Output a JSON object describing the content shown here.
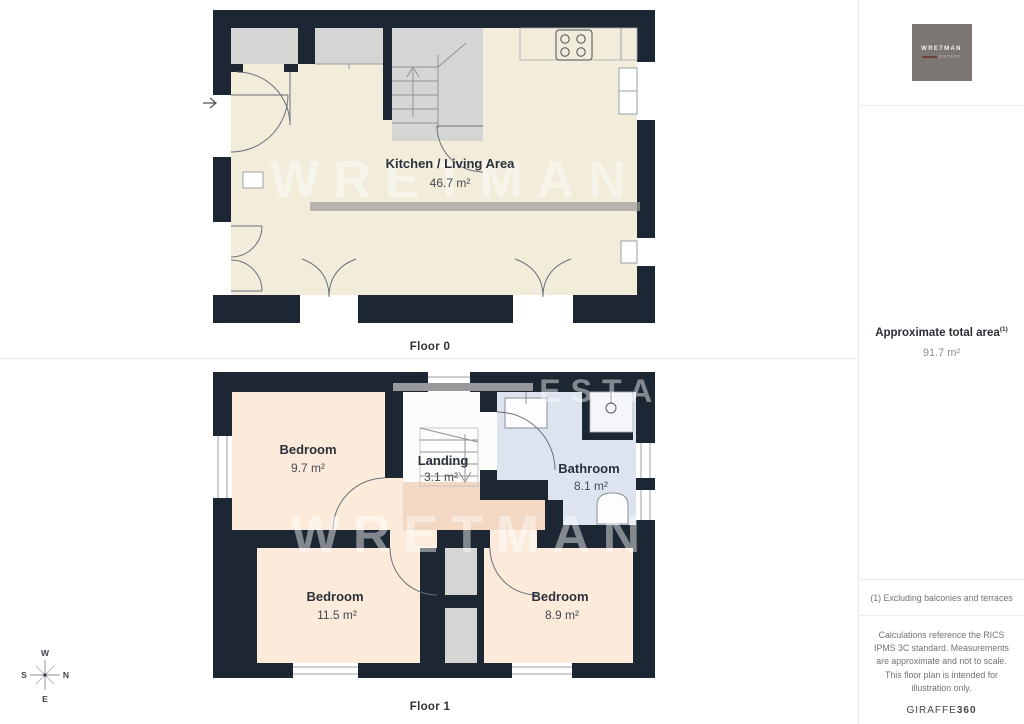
{
  "floor0": {
    "label": "Floor 0",
    "room": {
      "name": "Kitchen / Living Area",
      "area": "46.7 m²"
    }
  },
  "floor1": {
    "label": "Floor 1",
    "rooms": {
      "bedroom1": {
        "name": "Bedroom",
        "area": "9.7 m²"
      },
      "landing": {
        "name": "Landing",
        "area": "3.1 m²"
      },
      "bathroom": {
        "name": "Bathroom",
        "area": "8.1 m²"
      },
      "bedroom2": {
        "name": "Bedroom",
        "area": "11.5 m²"
      },
      "bedroom3": {
        "name": "Bedroom",
        "area": "8.9 m²"
      }
    }
  },
  "compass": {
    "n": "N",
    "s": "S",
    "e": "E",
    "w": "W"
  },
  "watermark": {
    "line1": "WRETMAN",
    "line2": "ESTATE"
  },
  "sidebar": {
    "logo": {
      "name": "WRETMAN",
      "subtitle": "ESTATE"
    },
    "total_area_label": "Approximate total area",
    "total_area_superscript": "(1)",
    "total_area_value": "91.7 m²",
    "footnote": "(1) Excluding balconies and terraces",
    "disclaimer": "Calculations reference the RICS IPMS 3C standard. Measurements are approximate and not to scale. This floor plan is intended for illustration only.",
    "brand": {
      "name": "GIRAFFE",
      "suffix": "360"
    }
  },
  "colors": {
    "wall": "#1d2734",
    "floor0_interior": "#f2ecda",
    "bedroom": "#fcebdb",
    "hallway": "#f3d8c4",
    "bathroom": "#dee4ef",
    "closet_gray": "#d5d5d3"
  }
}
